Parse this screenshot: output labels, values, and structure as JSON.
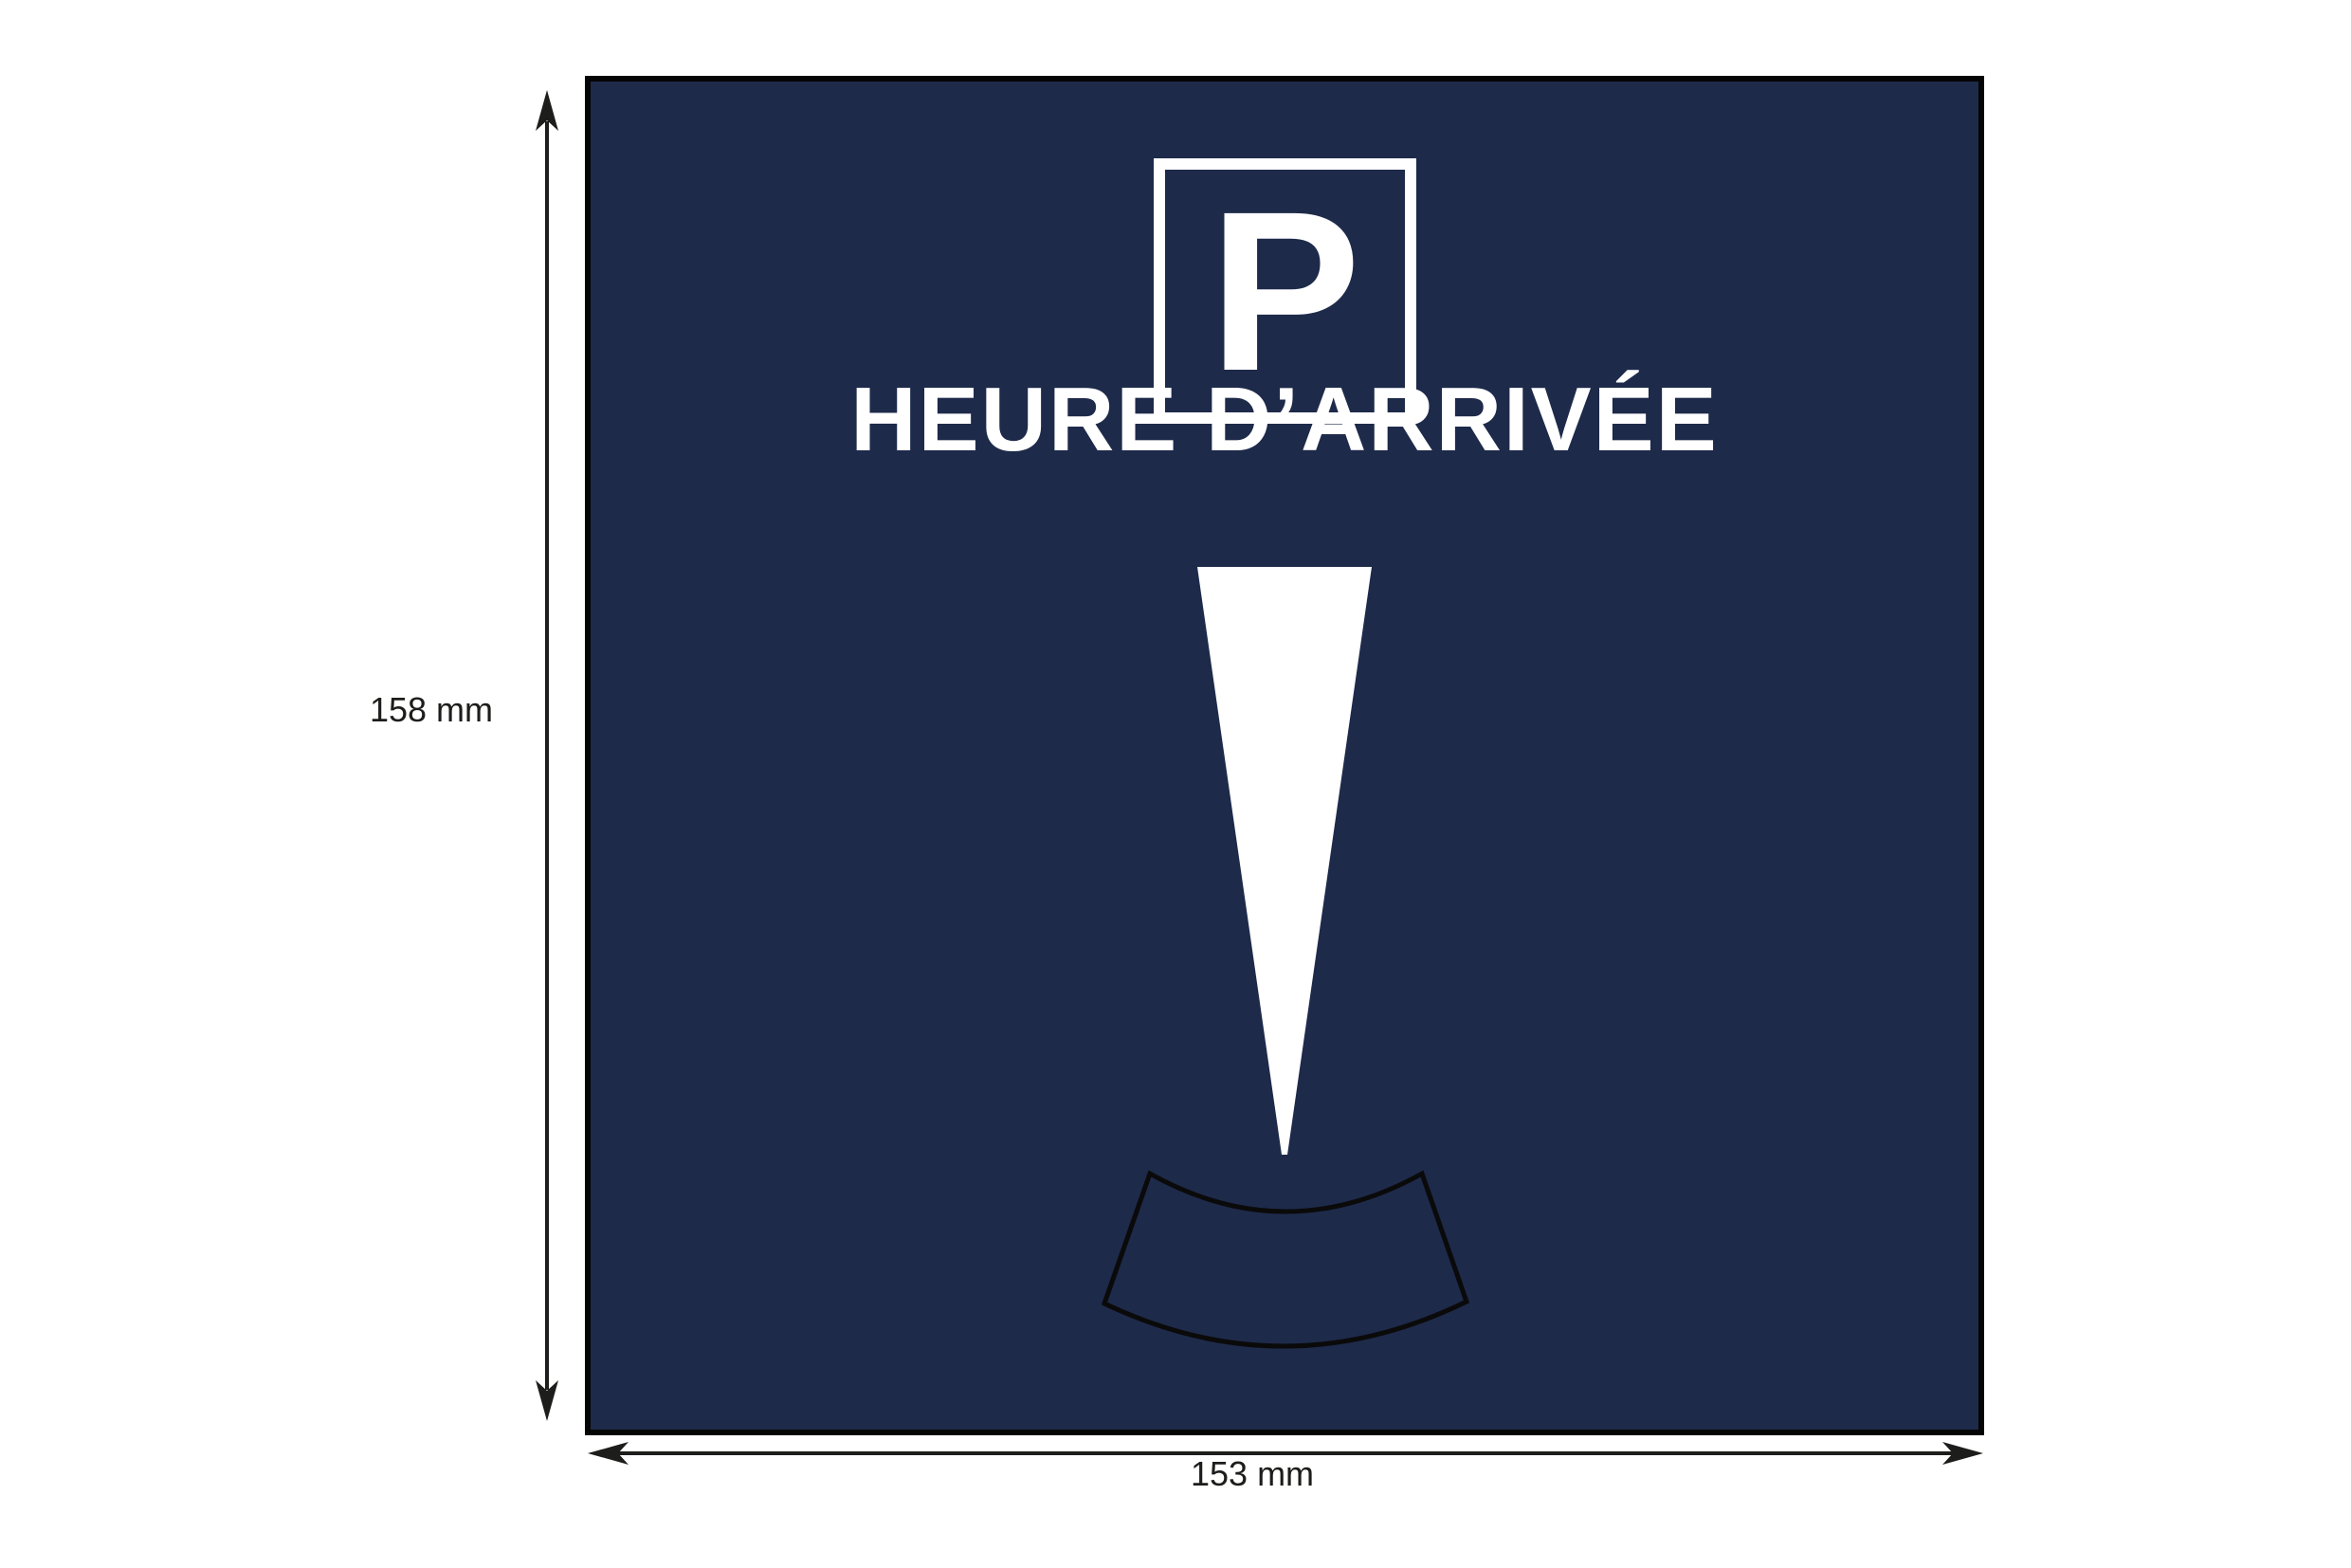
{
  "disc": {
    "symbol": "P",
    "title": "HEURE D’ARRIVÉE",
    "colors": {
      "card_background": "#1e2a4a",
      "card_border": "#050505",
      "symbol_and_title": "#ffffff",
      "window_outline": "#0a0a0a"
    },
    "icons": [
      "parking-square-icon",
      "time-pointer-triangle",
      "time-window-outline"
    ]
  },
  "dimensions": {
    "height": "158 mm",
    "width": "153 mm",
    "arrow_color": "#1d1d1b"
  }
}
